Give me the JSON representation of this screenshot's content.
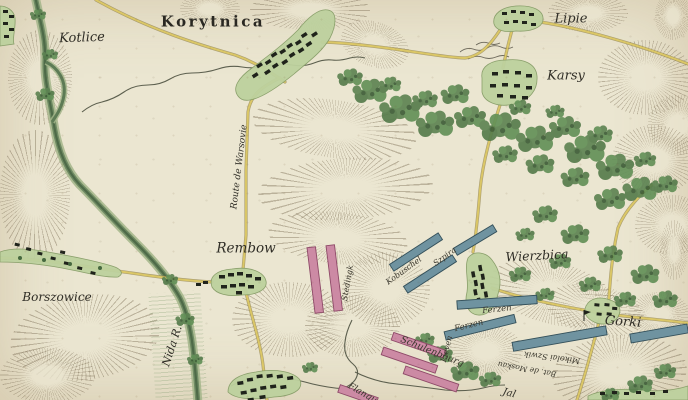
{
  "labels": {
    "kotlice": "Kotlice",
    "korytnica": "Korytnica",
    "lipie": "Lipie",
    "karsy": "Karsy",
    "rembow": "Rembow",
    "borszowice": "Borszowice",
    "wierzbica": "Wierzbica",
    "gorki": "Gorki",
    "nida_river": "Nida R.",
    "route_varsovie": "Route de Warsovie"
  },
  "units": {
    "stedingk": "Stedingk",
    "schulenbourg": "Schulenbourg",
    "kobuschel": "Kobuschel",
    "szpira": "Szpira",
    "ferzen_1": "Ferzen",
    "ferzen_2": "Ferzen",
    "lieven": "Lieven",
    "mikolai_szwik": "Mikolai Szwik",
    "bat_moskau": "Bat. de Moskau",
    "flanqueurs": "Flanqu",
    "partial_jal": "Jal"
  },
  "colors": {
    "paper": "#ebe6d1",
    "river": "#5d7b55",
    "riverbank": "#a3b58a",
    "road": "#dbc766",
    "road_edge": "#8a7a40",
    "village_fill": "#bdd19e",
    "village_edge": "#859c66",
    "building": "#1f231b",
    "forest": "#5d8352",
    "forest_dark": "#3c5c37",
    "hachure": "#7a6c54",
    "unit_pink": "#cc8aa4",
    "unit_pink_edge": "#8e4a68",
    "unit_blue": "#6f93a0",
    "unit_blue_edge": "#34505a",
    "ink": "#2f2d26"
  }
}
